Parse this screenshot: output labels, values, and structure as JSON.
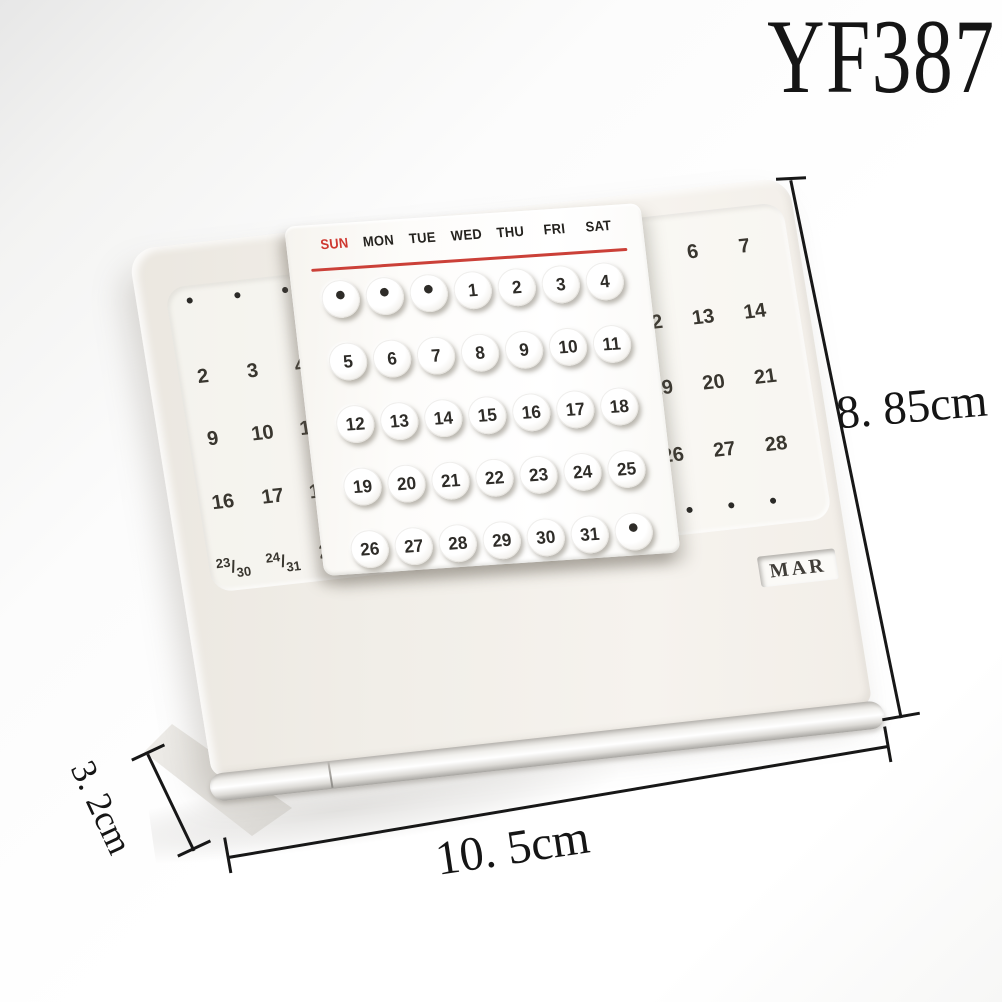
{
  "meta": {
    "model": "YF387"
  },
  "dimensions": {
    "height_label": "8. 85cm",
    "width_label": "10. 5cm",
    "depth_label": "3. 2cm"
  },
  "calendar": {
    "month_display": "MAR",
    "weekday_labels": [
      "SUN",
      "MON",
      "TUE",
      "WED",
      "THU",
      "FRI",
      "SAT"
    ],
    "slider_rows": [
      [
        "•",
        "•",
        "•",
        "1",
        "2",
        "3",
        "4"
      ],
      [
        "5",
        "6",
        "7",
        "8",
        "9",
        "10",
        "11"
      ],
      [
        "12",
        "13",
        "14",
        "15",
        "16",
        "17",
        "18"
      ],
      [
        "19",
        "20",
        "21",
        "22",
        "23",
        "24",
        "25"
      ],
      [
        "26",
        "27",
        "28",
        "29",
        "30",
        "31",
        "•"
      ]
    ],
    "left_panel": {
      "rows": [
        [
          "2",
          "3",
          "4"
        ],
        [
          "9",
          "10",
          "11"
        ],
        [
          "16",
          "17",
          "18"
        ]
      ],
      "fraction_row": [
        {
          "num": "23",
          "slash": "/",
          "den": "30"
        },
        {
          "num": "24",
          "slash": "/",
          "den": "31"
        },
        {
          "plain": "25"
        }
      ]
    },
    "right_panel": {
      "rows": [
        [
          "5",
          "6",
          "7"
        ],
        [
          "12",
          "13",
          "14"
        ],
        [
          "19",
          "20",
          "21"
        ],
        [
          "26",
          "27",
          "28"
        ]
      ]
    },
    "colors": {
      "sunday_red": "#ce372f",
      "underline_red": "#cb4038",
      "plate_tone": "#f1eee8",
      "number_ink": "#39362f"
    }
  }
}
